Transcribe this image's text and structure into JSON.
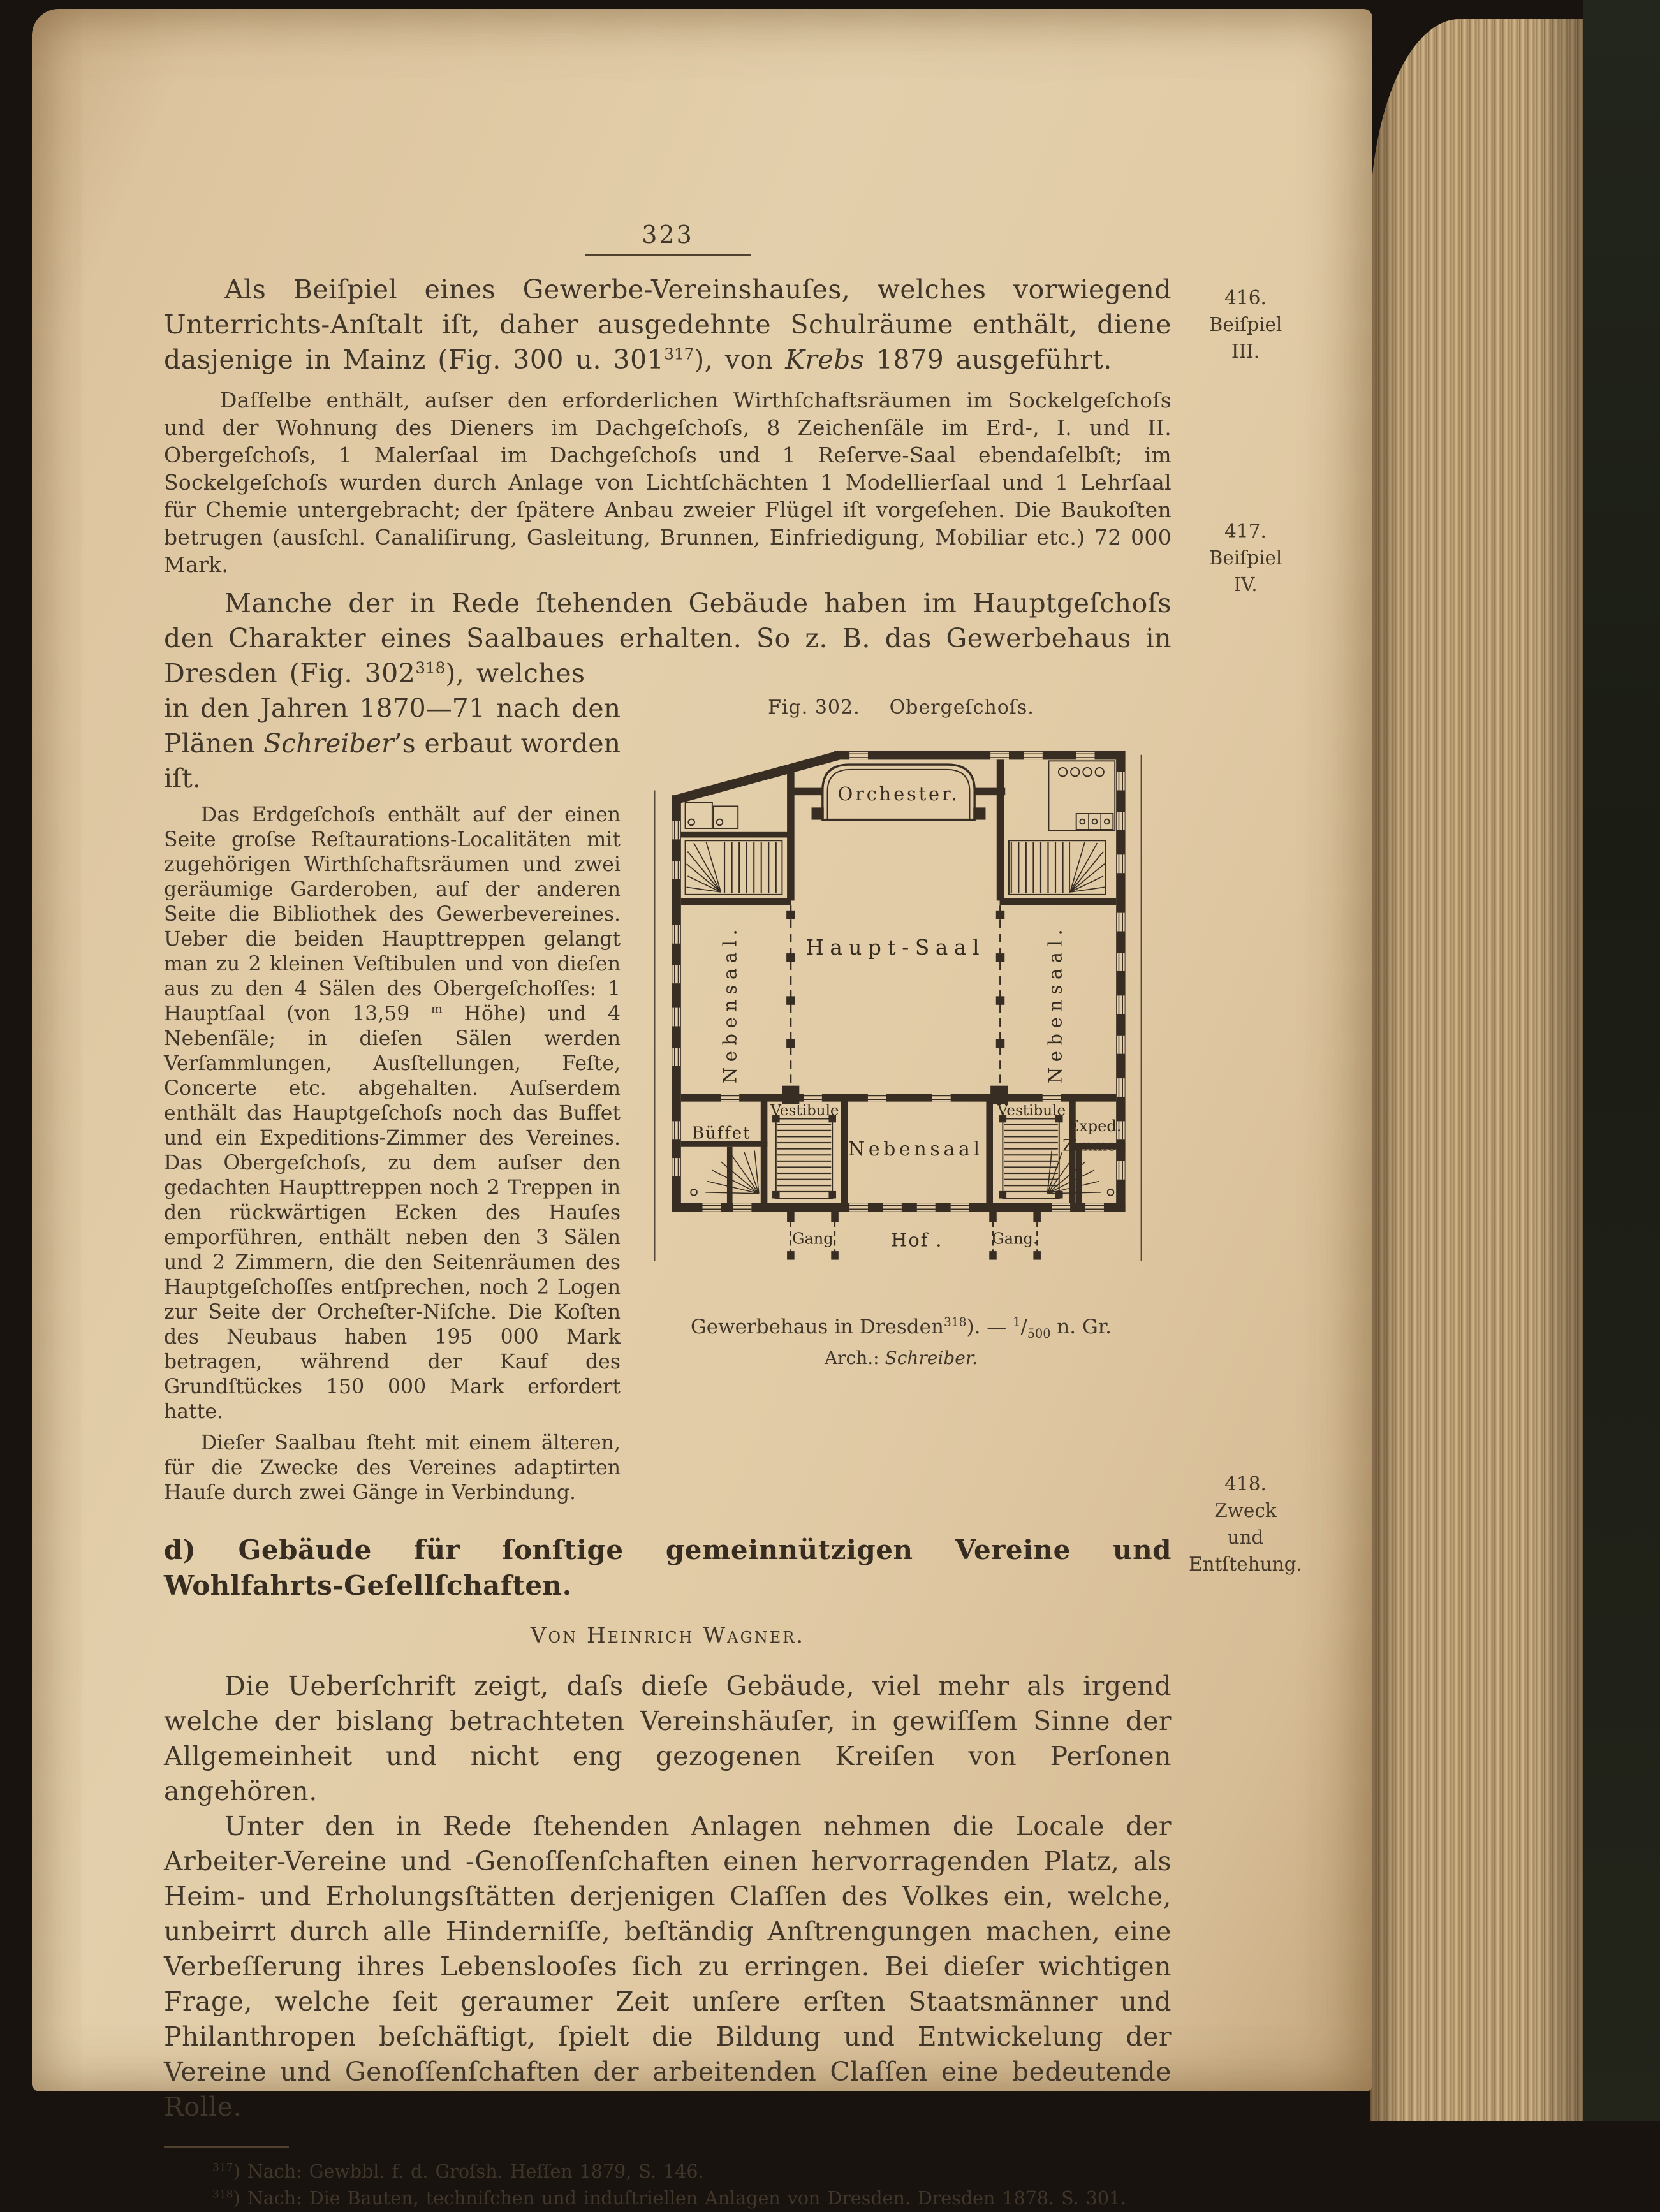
{
  "page_number": "323",
  "margin": {
    "m1": {
      "n": "416.",
      "l1": "Beiſpiel",
      "l2": "III."
    },
    "m2": {
      "n": "417.",
      "l1": "Beiſpiel",
      "l2": "IV."
    },
    "m3": {
      "n": "418.",
      "l1": "Zweck",
      "l2": "und",
      "l3": "Entſtehung."
    }
  },
  "body": {
    "p1": {
      "t1": "Als Beiſpiel eines Gewerbe-Vereinshauſes, welches vorwiegend Unterrichts-Anſtalt iſt, daher ausgedehnte Schulräume enthält, diene dasjenige in Mainz (Fig. 300 u. 301",
      "sup": "317",
      "t2": "), von ",
      "em": "Krebs",
      "t3": " 1879 ausgeführt."
    },
    "p2": "Daſſelbe enthält, auſser den erforderlichen Wirthſchaftsräumen im Sockelgeſchoſs und der Wohnung des Dieners im Dachgeſchoſs, 8 Zeichenſäle im Erd-, I. und II. Obergeſchoſs, 1 Malerſaal im Dachgeſchoſs und 1 Reſerve-Saal ebendaſelbſt; im Sockelgeſchoſs wurden durch Anlage von Lichtſchächten 1 Modellierſaal und 1 Lehrſaal für Chemie untergebracht; der ſpätere Anbau zweier Flügel iſt vorgeſehen. Die Baukoſten betrugen (ausſchl. Canaliſirung, Gasleitung, Brunnen, Einfriedigung, Mobiliar etc.) 72 000 Mark.",
    "p3": {
      "t1": "Manche der in Rede ſtehenden Gebäude haben im Hauptgeſchoſs den Charakter eines Saalbaues erhalten. So z. B. das Gewerbehaus in Dresden (Fig. 302",
      "sup": "318",
      "t2": "), welches"
    },
    "p3b": {
      "t1": "in den Jahren 1870—71 nach den Plänen ",
      "em": "Schreiber",
      "t2": "’s erbaut worden iſt."
    },
    "col1": {
      "t1": "Das Erdgeſchoſs enthält auf der einen Seite groſse Reſtaurations-Localitäten mit zugehörigen Wirthſchaftsräumen und zwei geräumige Garderoben, auf der anderen Seite die Bibliothek des Gewerbevereines. Ueber die beiden Haupttreppen gelangt man zu 2 kleinen Veſtibulen und von dieſen aus zu den 4 Sälen des Obergeſchoſſes: 1 Hauptſaal (von 13,59 ",
      "sup": "m",
      "t2": " Höhe) und 4 Nebenſäle; in dieſen Sälen werden Verſammlungen, Ausſtellungen, Feſte, Concerte etc. abgehalten. Auſserdem enthält das Hauptgeſchoſs noch das Buffet und ein Expeditions-Zimmer des Vereines. Das Obergeſchoſs, zu dem auſser den gedachten Haupttreppen noch 2 Treppen in den rückwärtigen Ecken des Hauſes emporführen, enthält neben den 3 Sälen und 2 Zimmern, die den Seitenräumen des Hauptgeſchoſſes entſprechen, noch 2 Logen zur Seite der Orcheſter-Niſche. Die Koſten des Neubaus haben 195 000 Mark betragen, während der Kauf des Grundſtückes 150 000 Mark erfordert hatte."
    },
    "col2": "Dieſer Saalbau ſteht mit einem älteren, für die Zwecke des Vereines adaptirten Hauſe durch zwei Gänge in Verbindung."
  },
  "figure": {
    "fig_label": "Fig. 302.",
    "fig_name": "Obergeſchoſs.",
    "caption": {
      "t1": "Gewerbehaus in Dresden",
      "sup": "318",
      "t2": "). — ",
      "num": "1",
      "den": "500",
      "t3": " n. Gr."
    },
    "credit": {
      "t1": "Arch.: ",
      "em": "Schreiber."
    },
    "rooms": {
      "orchester": "Orchester.",
      "hauptsaal": "Haupt-Saal",
      "nebensaal_left": "Nebensaal.",
      "nebensaal_right": "Nebensaal.",
      "nebensaal_center": "Nebensaal",
      "buffet": "Büffet",
      "vestibule_left": "Vestibule",
      "vestibule_right": "Vestibule",
      "exped1": "Exped.",
      "exped2": "Zimmer.",
      "gang_left": "Gang",
      "gang_right": "Gang.",
      "hof": "Hof ."
    }
  },
  "section": {
    "heading": "d) Gebäude für ſonſtige gemeinnützigen Vereine und Wohlfahrts-Geſellſchaften.",
    "byline": "Von Heinrich Wagner.",
    "p1": "Die Ueberſchrift zeigt, daſs dieſe Gebäude, viel mehr als irgend welche der bislang betrachteten Vereinshäuſer, in gewiſſem Sinne der Allgemeinheit und nicht eng gezogenen Kreiſen von Perſonen angehören.",
    "p2": "Unter den in Rede ſtehenden Anlagen nehmen die Locale der Arbeiter-Vereine und -Genoſſenſchaften einen hervorragenden Platz, als Heim- und Erholungsſtätten derjenigen Claſſen des Volkes ein, welche, unbeirrt durch alle Hinderniſſe, beſtändig Anſtrengungen machen, eine Verbeſſerung ihres Lebenslooſes ſich zu erringen. Bei dieſer wichtigen Frage, welche ſeit geraumer Zeit unſere erſten Staatsmänner und Philanthropen beſchäftigt, ſpielt die Bildung und Entwickelung der Vereine und Genoſſenſchaften der arbeitenden Claſſen eine bedeutende Rolle."
  },
  "footnotes": {
    "f1": {
      "sup": "317",
      "t": ") Nach: Gewbbl. f. d. Groſsh. Heſſen 1879, S. 146."
    },
    "f2": {
      "sup": "318",
      "t": ") Nach: Die Bauten, techniſchen und induſtriellen Anlagen von Dresden.  Dresden 1878. S. 301."
    }
  }
}
